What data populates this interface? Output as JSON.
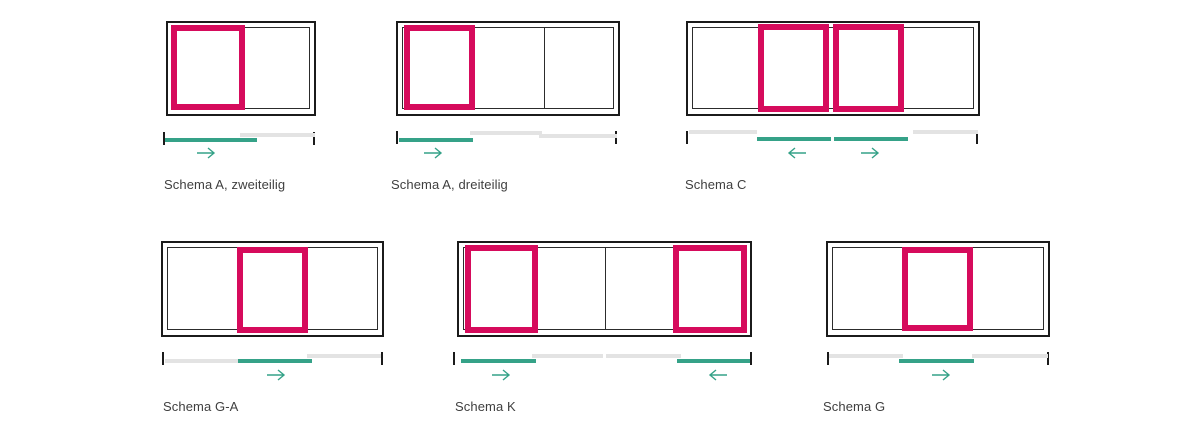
{
  "colors": {
    "panel_pink": "#d60b5c",
    "track_teal": "#35a288",
    "track_gray": "#e3e3e3",
    "frame_black": "#1b1b1b",
    "thin_line": "#2c2c2c",
    "label_text": "#3f3f3f"
  },
  "diagrams": [
    {
      "id": "schema-a-zweiteilig",
      "label": "Schema A, zweiteilig",
      "sections": 2,
      "sliding_panels": 1,
      "arrows": [
        "right"
      ]
    },
    {
      "id": "schema-a-dreiteilig",
      "label": "Schema A, dreiteilig",
      "sections": 3,
      "sliding_panels": 1,
      "arrows": [
        "right"
      ]
    },
    {
      "id": "schema-c",
      "label": "Schema C",
      "sections": 4,
      "sliding_panels": 2,
      "arrows": [
        "left",
        "right"
      ]
    },
    {
      "id": "schema-g-a",
      "label": "Schema G-A",
      "sections": 3,
      "sliding_panels": 1,
      "arrows": [
        "right"
      ]
    },
    {
      "id": "schema-k",
      "label": "Schema K",
      "sections": 4,
      "sliding_panels": 2,
      "arrows": [
        "right",
        "left"
      ]
    },
    {
      "id": "schema-g",
      "label": "Schema G",
      "sections": 3,
      "sliding_panels": 1,
      "arrows": [
        "right"
      ]
    }
  ]
}
